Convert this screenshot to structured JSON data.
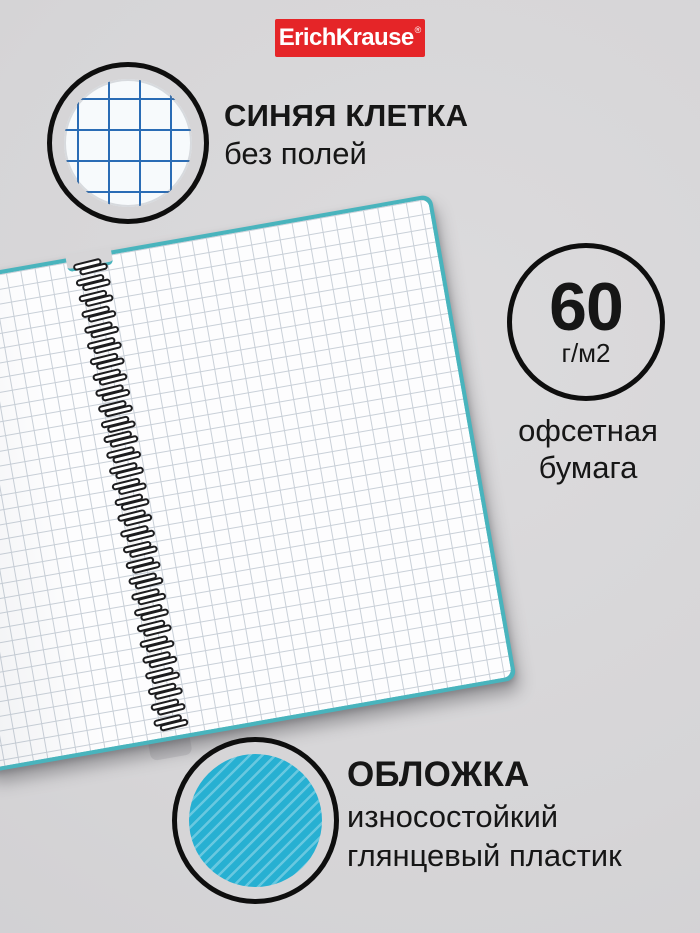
{
  "brand": {
    "name": "ErichKrause",
    "registered_mark": "®"
  },
  "features": {
    "grid": {
      "title": "СИНЯЯ КЛЕТКА",
      "subtitle": "без полей"
    },
    "paper": {
      "weight": "60",
      "unit": "г/м2",
      "line1": "офсетная",
      "line2": "бумага"
    },
    "cover": {
      "title": "ОБЛОЖКА",
      "line1": "износостойкий",
      "line2": "глянцевый пластик"
    }
  },
  "notebook": {
    "spiral_coils": 30,
    "ruling": "square-grid"
  },
  "colors": {
    "background": "#d6d5d7",
    "brand_red": "#e52528",
    "cover_teal": "#49b4bd",
    "cover_cyan": "#27b0d2",
    "grid_blue": "#2a6cb5",
    "page_grid": "#c9d0d8",
    "ink": "#161616"
  }
}
